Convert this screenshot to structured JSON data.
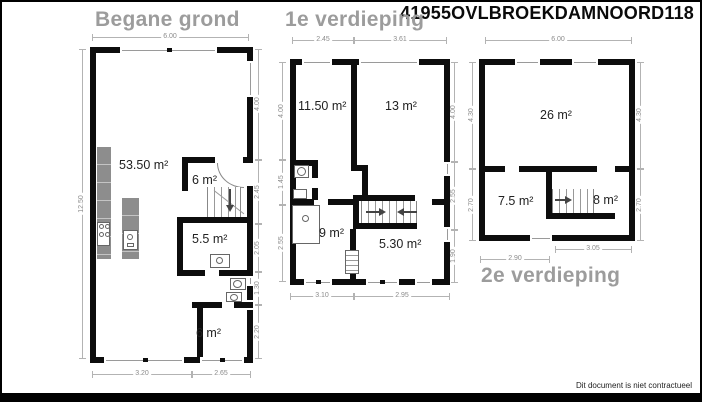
{
  "header": {
    "code": "41955OVLBROEKDAMNOORD118"
  },
  "footer": {
    "disclaimer": "Dit document is niet contractueel"
  },
  "colors": {
    "wall": "#0d0d0d",
    "dimension": "#b3b3b3",
    "title_gray": "#9c9c9c",
    "counter_gray": "#8d8d8d"
  },
  "ground": {
    "title": "Begane grond",
    "rooms": {
      "living": "53.50 m²",
      "hall": "6 m²",
      "storage": "5.5 m²",
      "back": "6 m²"
    },
    "dims": {
      "top": "6.00",
      "left": "12.50",
      "right": [
        "4.00",
        "2.45",
        "2.05",
        "1.30",
        "2.20"
      ],
      "bottom": [
        "3.20",
        "2.65"
      ]
    }
  },
  "first": {
    "title": "1e verdieping",
    "rooms": {
      "bedroom1": "11.50 m²",
      "bedroom2": "13 m²",
      "bedroom3": "9 m²",
      "landing": "5.30 m²"
    },
    "dims": {
      "top": [
        "2.45",
        "3.61"
      ],
      "left": [
        "4.00",
        "1.45",
        "2.55"
      ],
      "right": [
        "4.00",
        "2.55",
        "1.90"
      ],
      "bottom": [
        "3.10",
        "2.95"
      ]
    }
  },
  "second": {
    "title": "2e verdieping",
    "rooms": {
      "attic": "26 m²",
      "left": "7.5 m²",
      "right": "8 m²"
    },
    "dims": {
      "top": "6.00",
      "left": [
        "4.30",
        "2.70"
      ],
      "right": [
        "4.30",
        "2.70"
      ],
      "bottom": [
        "2.90",
        "3.05"
      ]
    }
  }
}
